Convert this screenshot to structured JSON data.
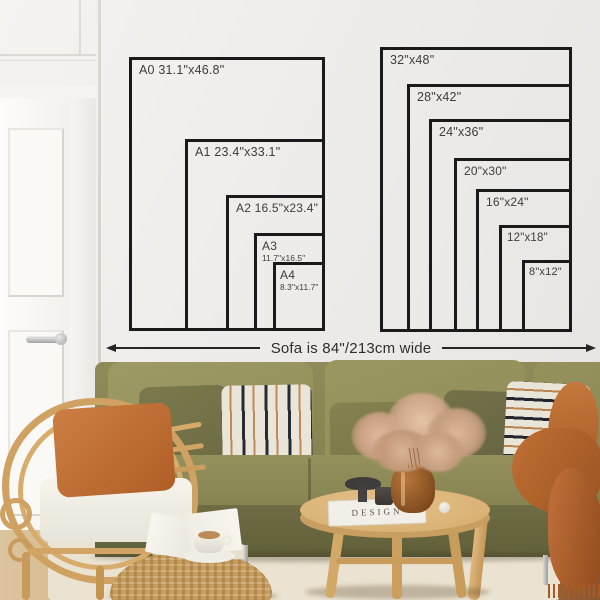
{
  "meta": {
    "title": "Poster size guide above sofa mockup"
  },
  "wall_charts": {
    "a_series": {
      "sizes": [
        {
          "id": "A0",
          "label": "A0 31.1\"x46.8\""
        },
        {
          "id": "A1",
          "label": "A1 23.4\"x33.1\""
        },
        {
          "id": "A2",
          "label": "A2 16.5\"x23.4\""
        },
        {
          "id": "A3",
          "label": "A3",
          "sublabel": "11.7\"x16.5\""
        },
        {
          "id": "A4",
          "label": "A4",
          "sublabel": "8.3\"x11.7\""
        }
      ]
    },
    "inch_series": {
      "sizes": [
        {
          "id": "32x48",
          "label": "32\"x48\""
        },
        {
          "id": "28x42",
          "label": "28\"x42\""
        },
        {
          "id": "24x36",
          "label": "24\"x36\""
        },
        {
          "id": "20x30",
          "label": "20\"x30\""
        },
        {
          "id": "16x24",
          "label": "16\"x24\""
        },
        {
          "id": "12x18",
          "label": "12\"x18\""
        },
        {
          "id": "8x12",
          "label": "8\"x12\""
        }
      ]
    }
  },
  "sofa_annotation": {
    "text": "Sofa is 84\"/213cm wide"
  },
  "decor": {
    "book_spine_title": "DESIGN"
  },
  "colors": {
    "frame_outline": "#1a1a1a",
    "label_text": "#3d3d3d",
    "wall": "#edebe8",
    "sofa_olive": "#8d8a58",
    "cushion_olive": "#9a9660",
    "pillow_rust": "#c0702f",
    "blanket_rust": "#b26228",
    "stripe_black": "#262a33",
    "stripe_tan": "#b9844f",
    "rattan": "#d2a566",
    "table_wood": "#dcb579",
    "floor_wood": "#9a6538"
  }
}
